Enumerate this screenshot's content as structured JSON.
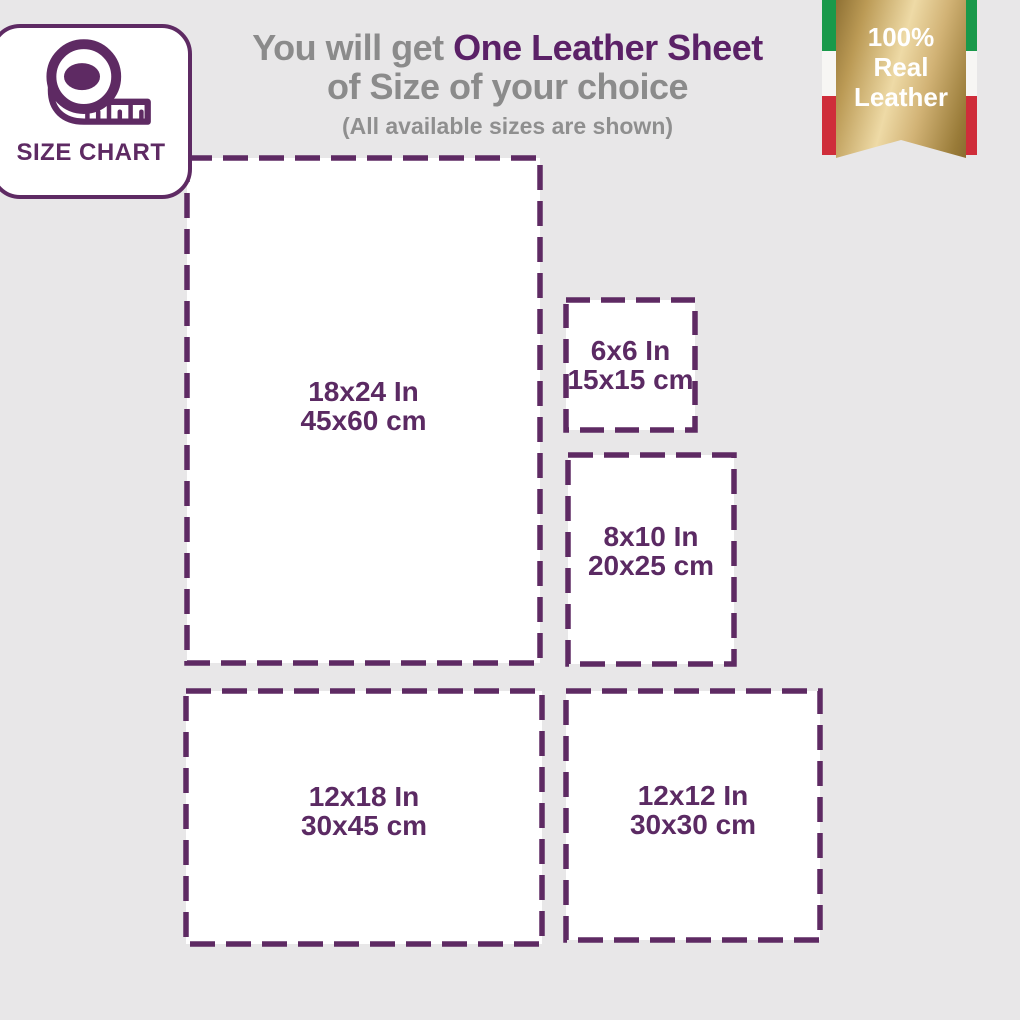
{
  "colors": {
    "background": "#e8e7e8",
    "accent_purple": "#5e2a63",
    "heading_gray": "#8b8b8b",
    "box_fill": "#ffffff",
    "ribbon_gold_light": "#eedaa6",
    "ribbon_gold_dark": "#8f7134",
    "flag_green": "#19994a",
    "flag_white": "#f7f6f4",
    "flag_red": "#cf2d3a"
  },
  "heading": {
    "prefix": "You will get ",
    "highlight": "One Leather Sheet",
    "line2": "of Size of your choice",
    "note": "(All available sizes are shown)"
  },
  "badge": {
    "label": "SIZE CHART",
    "icon": "tape-measure-icon"
  },
  "ribbon": {
    "line1": "100%",
    "line2": "Real",
    "line3": "Leather"
  },
  "sizes": [
    {
      "id": "18x24",
      "inches": "18x24 In",
      "cm": "45x60 cm"
    },
    {
      "id": "6x6",
      "inches": "6x6 In",
      "cm": "15x15 cm"
    },
    {
      "id": "8x10",
      "inches": "8x10 In",
      "cm": "20x25 cm"
    },
    {
      "id": "12x18",
      "inches": "12x18 In",
      "cm": "30x45 cm"
    },
    {
      "id": "12x12",
      "inches": "12x12 In",
      "cm": "30x30 cm"
    }
  ]
}
